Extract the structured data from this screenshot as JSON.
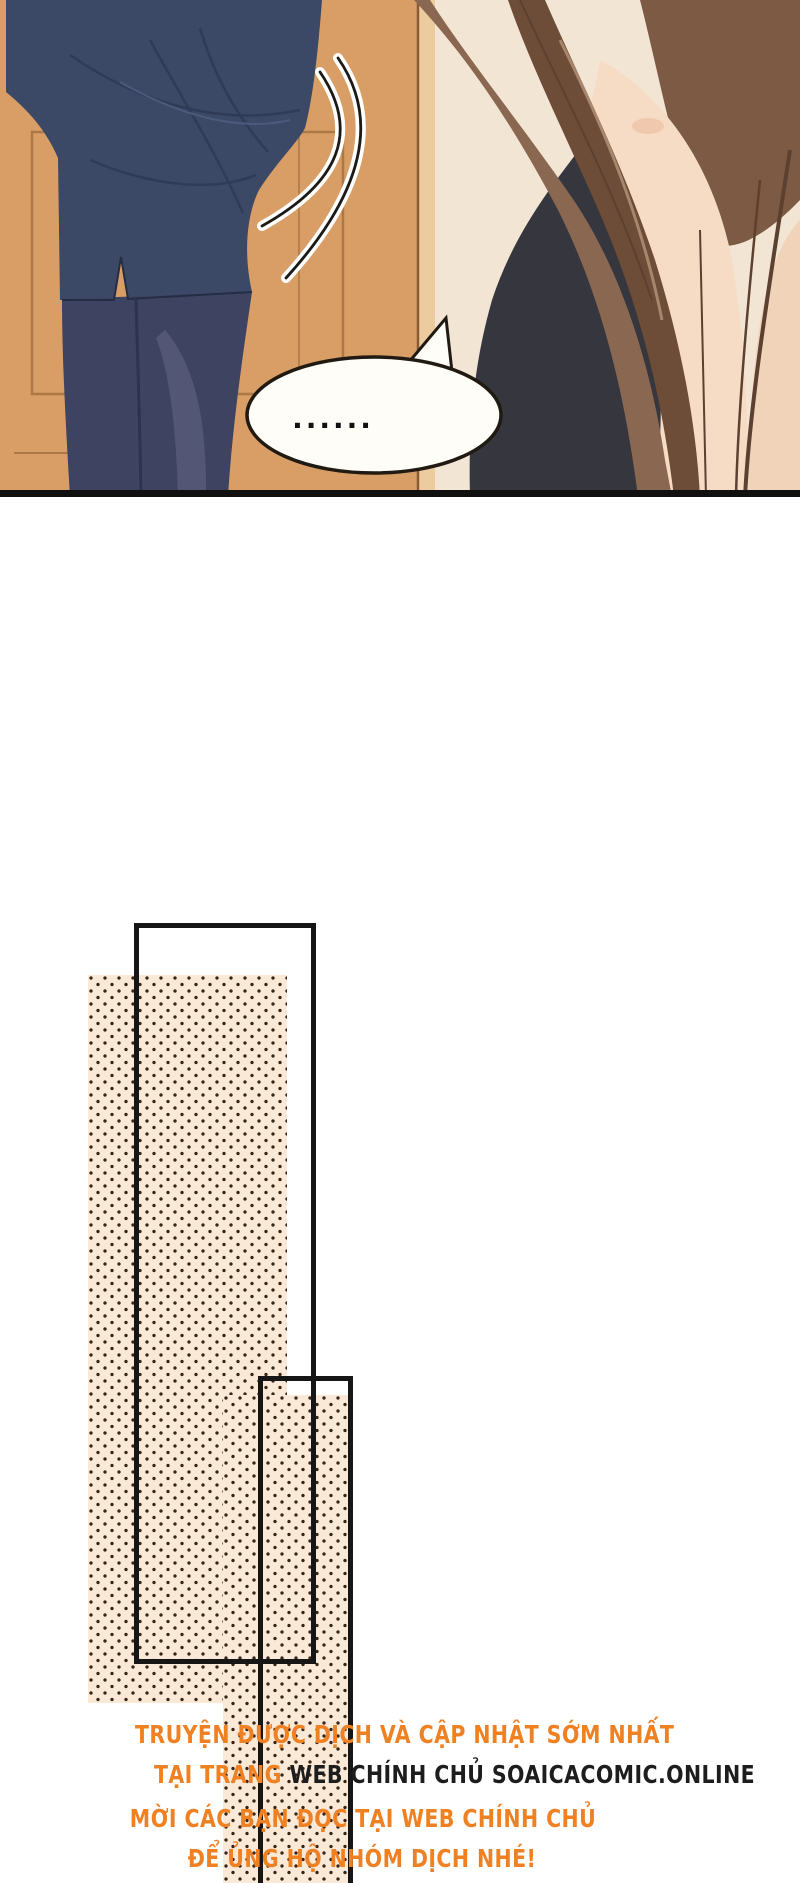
{
  "page": {
    "kind": "manhua-webtoon-page",
    "background": "#ffffff"
  },
  "panel": {
    "speech_bubble_text": "......",
    "colors": {
      "wall_orange": "#d99e66",
      "door_line": "#ad7848",
      "door_frame_strip": "#eccb9f",
      "right_background": "#f3e5d4",
      "suit_navy": "#3b4866",
      "suit_fold": "#2f3b57",
      "trousers": "#3e4361",
      "hair_brown": "#7c5a43",
      "hair_dark": "#5d4130",
      "skin": "#f6dcc5",
      "black_top": "#35363e",
      "bubble_fill": "#fffdf7",
      "ink_outline": "#1c1a16",
      "panel_border": "#101010"
    }
  },
  "shapes": {
    "outline_rect_large": {
      "left": 134,
      "top": 923,
      "width": 182,
      "height": 741,
      "border_color": "#161616"
    },
    "outline_rect_small": {
      "left": 258,
      "top": 1376,
      "width": 95,
      "height": 507,
      "border_color": "#161616"
    },
    "dot_area_tall": {
      "left": 88,
      "top": 975,
      "width": 199,
      "height": 728
    },
    "dot_area_bottom": {
      "left": 223,
      "top": 1395,
      "width": 129,
      "height": 488
    },
    "dot_background": "#fbe9d8",
    "dot_color": "#3a2417"
  },
  "footer": {
    "accent_color": "#ef8122",
    "dark_color": "#1d1d1d",
    "line1": "TRUYỆN ĐƯỢC DỊCH VÀ CẬP NHẬT SỚM NHẤT",
    "line2_prefix": "TẠI TRANG ",
    "line2_main": "WEB CHÍNH CHỦ SOAICACOMIC.ONLINE",
    "line3": "MỜI CÁC BẠN ĐỌC TẠI WEB CHÍNH CHỦ",
    "line4": "ĐỂ ỦNG HỘ NHÓM DỊCH NHÉ!"
  }
}
